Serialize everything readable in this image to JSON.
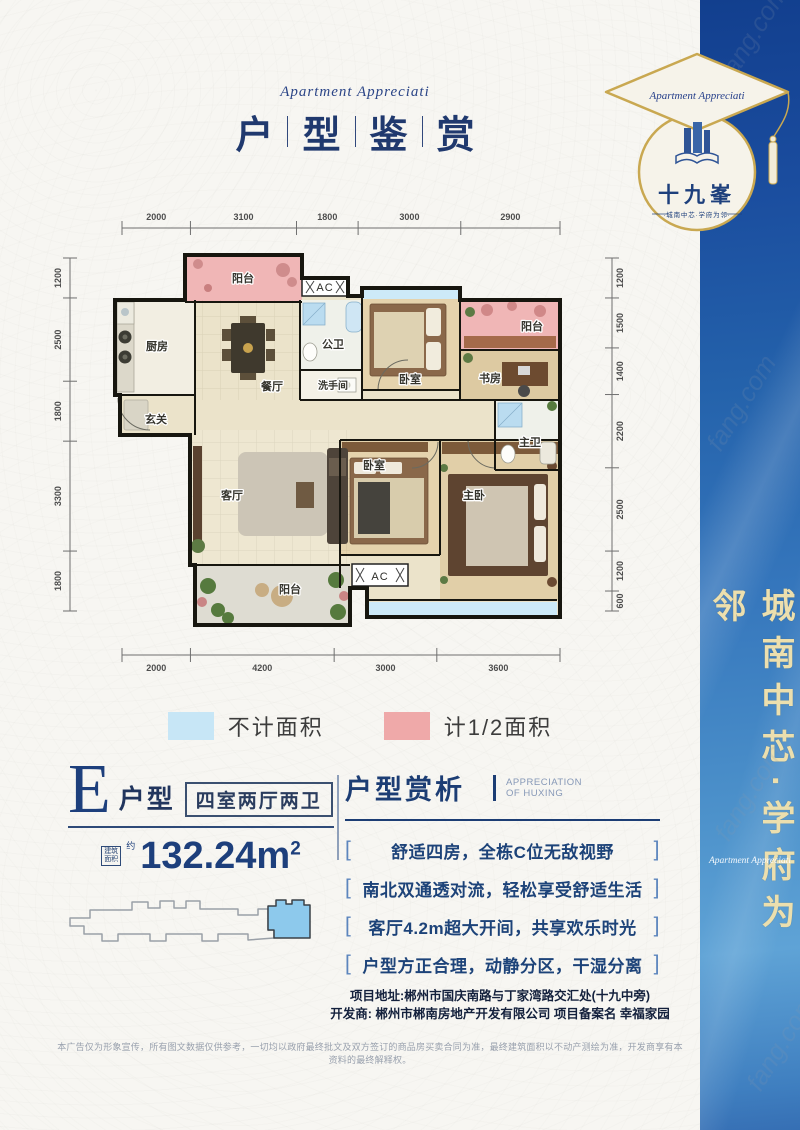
{
  "header": {
    "script_title": "Apartment Appreciati",
    "title_chars": [
      "户",
      "型",
      "鉴",
      "赏"
    ]
  },
  "logo": {
    "script": "Apartment Appreciati",
    "name": "十九峯",
    "tagline": "·城南中芯·学府为邻·"
  },
  "sidebar": {
    "vertical_text": "城南中芯·学府为邻",
    "script": "Apartment Appreciati"
  },
  "watermark": "fang.com",
  "floorplan": {
    "rooms": [
      {
        "id": "balcony-north",
        "label": "阳台"
      },
      {
        "id": "ac-north",
        "label": "AC"
      },
      {
        "id": "kitchen",
        "label": "厨房"
      },
      {
        "id": "dining",
        "label": "餐厅"
      },
      {
        "id": "guest-bath",
        "label": "公卫"
      },
      {
        "id": "washroom",
        "label": "洗手间"
      },
      {
        "id": "bedroom-north",
        "label": "卧室"
      },
      {
        "id": "balcony-east",
        "label": "阳台"
      },
      {
        "id": "study",
        "label": "书房"
      },
      {
        "id": "master-bath",
        "label": "主卫"
      },
      {
        "id": "entry",
        "label": "玄关"
      },
      {
        "id": "living",
        "label": "客厅"
      },
      {
        "id": "bedroom-mid",
        "label": "卧室"
      },
      {
        "id": "master-bedroom",
        "label": "主卧"
      },
      {
        "id": "balcony-south",
        "label": "阳台"
      },
      {
        "id": "ac-south",
        "label": "AC"
      }
    ],
    "dims": {
      "top": [
        2000,
        3100,
        1800,
        3000,
        2900
      ],
      "bottom": [
        2000,
        4200,
        3000,
        3600
      ],
      "left": [
        1200,
        2500,
        1800,
        3300,
        1800
      ],
      "right": [
        1200,
        1500,
        1400,
        2200,
        2500,
        1200,
        600
      ]
    }
  },
  "legend": {
    "items": [
      {
        "label": "不计面积",
        "color": "#c7e6f6"
      },
      {
        "label": "计1/2面积",
        "color": "#efa9a9"
      }
    ]
  },
  "unit": {
    "letter": "E",
    "type_label": "户型",
    "layout_badge": "四室两厅两卫",
    "area_label_line1": "建筑",
    "area_label_line2": "面积",
    "area_approx": "约",
    "area_value": "132.24m",
    "area_exp": "2"
  },
  "analysis": {
    "title": "户型赏析",
    "subtitle_line1": "APPRECIATION",
    "subtitle_line2": "OF HUXING",
    "bracket_open": "[",
    "bracket_close": "]",
    "points": [
      "舒适四房，全栋C位无敌视野",
      "南北双通透对流，轻松享受舒适生活",
      "客厅4.2m超大开间，共享欢乐时光",
      "户型方正合理，动静分区，干湿分离"
    ]
  },
  "info": {
    "address_label": "项目地址:",
    "address": "郴州市国庆南路与丁家湾路交汇处(十九中旁)",
    "developer_label": "开发商:",
    "developer": "郴州市郴南房地产开发有限公司 项目备案名 幸福家园"
  },
  "disclaimer": "本广告仅为形象宣传，所有图文数据仅供参考，一切均以政府最终批文及双方签订的商品房买卖合同为准，最终建筑面积以不动产测绘为准，开发商享有本资料的最终解释权。",
  "colors": {
    "sidebar_blue": "#2462ab",
    "brand_navy": "#1d3f7c",
    "gold": "#c9a851",
    "no_area_blue": "#c7e6f6",
    "half_area_pink": "#efa9a9"
  }
}
